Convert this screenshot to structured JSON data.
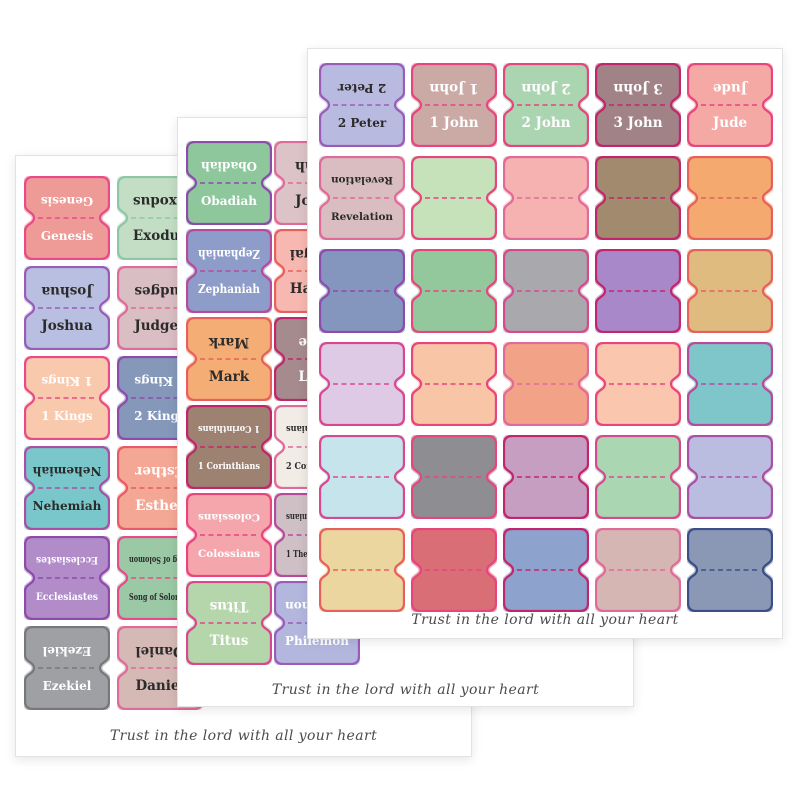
{
  "product": {
    "description": "three overlapping sheets of bible book index tab stickers",
    "quote": "Trust in the lord with all your heart"
  },
  "sheets": [
    {
      "name": "back-sheet-old-testament-1",
      "quote": "Trust in the lord with all your heart",
      "tabs": [
        {
          "row": 0,
          "col": 0,
          "label": "Genesis",
          "fill": "#ee9a96",
          "border": "#e84a8a",
          "ink": "#ffffff"
        },
        {
          "row": 0,
          "col": 1,
          "label": "Exodus",
          "fill": "#c3dec5",
          "border": "#8ec7a8",
          "ink": "#2b2b2b"
        },
        {
          "row": 1,
          "col": 0,
          "label": "Joshua",
          "fill": "#b9bfe0",
          "border": "#9a5cb8",
          "ink": "#2b2b2b"
        },
        {
          "row": 1,
          "col": 1,
          "label": "Judges",
          "fill": "#d9bec4",
          "border": "#e06a9a",
          "ink": "#2b2b2b"
        },
        {
          "row": 2,
          "col": 0,
          "label": "1 Kings",
          "fill": "#f9c9ad",
          "border": "#e84a8a",
          "ink": "#ffffff"
        },
        {
          "row": 2,
          "col": 1,
          "label": "2 Kings",
          "fill": "#8598ba",
          "border": "#8d4bab",
          "ink": "#ffffff"
        },
        {
          "row": 3,
          "col": 0,
          "label": "Nehemiah",
          "fill": "#79c7cb",
          "border": "#a94fa4",
          "ink": "#2b2b2b"
        },
        {
          "row": 3,
          "col": 1,
          "label": "Esther",
          "fill": "#f5a795",
          "border": "#e85a6a",
          "ink": "#ffffff"
        },
        {
          "row": 4,
          "col": 0,
          "label": "Ecclesiastes",
          "fill": "#b28bc9",
          "border": "#8d4bab",
          "ink": "#ffffff"
        },
        {
          "row": 4,
          "col": 1,
          "label": "Song of Solomon",
          "fill": "#9bc9a5",
          "border": "#e84a8a",
          "ink": "#2b2b2b"
        },
        {
          "row": 5,
          "col": 0,
          "label": "Ezekiel",
          "fill": "#9fa0a4",
          "border": "#77787c",
          "ink": "#ffffff"
        },
        {
          "row": 5,
          "col": 1,
          "label": "Daniel",
          "fill": "#d5b9b5",
          "border": "#e06a9a",
          "ink": "#2b2b2b"
        }
      ]
    },
    {
      "name": "middle-sheet-prophets-new-testament",
      "quote": "Trust in the lord with all your heart",
      "tabs": [
        {
          "row": 0,
          "col": 0,
          "label": "Obadiah",
          "fill": "#8dc79b",
          "border": "#8d4bab",
          "ink": "#ffffff"
        },
        {
          "row": 0,
          "col": 1,
          "label": "Jonah",
          "fill": "#dcc3c7",
          "border": "#e06a9a",
          "ink": "#2b2b2b"
        },
        {
          "row": 1,
          "col": 0,
          "label": "Zephaniah",
          "fill": "#8d9cc9",
          "border": "#b84a9e",
          "ink": "#ffffff"
        },
        {
          "row": 1,
          "col": 1,
          "label": "Haggai",
          "fill": "#f6b8b0",
          "border": "#e8605e",
          "ink": "#2b2b2b"
        },
        {
          "row": 2,
          "col": 0,
          "label": "Mark",
          "fill": "#f5ad76",
          "border": "#e8605e",
          "ink": "#2b2b2b"
        },
        {
          "row": 2,
          "col": 1,
          "label": "Luke",
          "fill": "#a58a8e",
          "border": "#c2256b",
          "ink": "#ffffff"
        },
        {
          "row": 3,
          "col": 0,
          "label": "1 Corinthians",
          "fill": "#9d8271",
          "border": "#c2256b",
          "ink": "#ffffff"
        },
        {
          "row": 3,
          "col": 1,
          "label": "2 Corinthians",
          "fill": "#f2ece6",
          "border": "#e06a9a",
          "ink": "#2b2b2b"
        },
        {
          "row": 4,
          "col": 0,
          "label": "Colossians",
          "fill": "#f5a6ad",
          "border": "#e8447e",
          "ink": "#ffffff"
        },
        {
          "row": 4,
          "col": 1,
          "label": "1 Thessalonians",
          "fill": "#cfc0c6",
          "border": "#b84a9e",
          "ink": "#2b2b2b"
        },
        {
          "row": 5,
          "col": 0,
          "label": "Titus",
          "fill": "#b5d6aa",
          "border": "#d84890",
          "ink": "#ffffff"
        },
        {
          "row": 5,
          "col": 1,
          "label": "Philemon",
          "fill": "#b3b7de",
          "border": "#9a5cb8",
          "ink": "#ffffff"
        }
      ]
    },
    {
      "name": "front-sheet-new-testament-end",
      "quote": "Trust in the lord with all your heart",
      "tabs": [
        {
          "row": 0,
          "col": 0,
          "label": "2 Peter",
          "fill": "#b9badf",
          "border": "#9a5cb8",
          "ink": "#2b2b2b"
        },
        {
          "row": 0,
          "col": 1,
          "label": "1 John",
          "fill": "#cba9a5",
          "border": "#e8447e",
          "ink": "#ffffff"
        },
        {
          "row": 0,
          "col": 2,
          "label": "2 John",
          "fill": "#abd5b1",
          "border": "#e8447e",
          "ink": "#ffffff"
        },
        {
          "row": 0,
          "col": 3,
          "label": "3 John",
          "fill": "#a18287",
          "border": "#c2256b",
          "ink": "#ffffff"
        },
        {
          "row": 0,
          "col": 4,
          "label": "Jude",
          "fill": "#f4a9a5",
          "border": "#e8447e",
          "ink": "#ffffff"
        },
        {
          "row": 1,
          "col": 0,
          "label": "Revelation",
          "fill": "#d9bdc1",
          "border": "#e06a9a",
          "ink": "#2b2b2b"
        },
        {
          "row": 1,
          "col": 1,
          "label": "",
          "fill": "#c5e2bb",
          "border": "#e8447e",
          "ink": "#2b2b2b"
        },
        {
          "row": 1,
          "col": 2,
          "label": "",
          "fill": "#f6b1b1",
          "border": "#e06a9a",
          "ink": "#2b2b2b"
        },
        {
          "row": 1,
          "col": 3,
          "label": "",
          "fill": "#a18a6e",
          "border": "#c2256b",
          "ink": "#2b2b2b"
        },
        {
          "row": 1,
          "col": 4,
          "label": "",
          "fill": "#f4a96e",
          "border": "#e8605e",
          "ink": "#2b2b2b"
        },
        {
          "row": 2,
          "col": 0,
          "label": "",
          "fill": "#8496be",
          "border": "#8d4bab",
          "ink": "#2b2b2b"
        },
        {
          "row": 2,
          "col": 1,
          "label": "",
          "fill": "#93c89d",
          "border": "#e8447e",
          "ink": "#2b2b2b"
        },
        {
          "row": 2,
          "col": 2,
          "label": "",
          "fill": "#a9a9ad",
          "border": "#d84890",
          "ink": "#2b2b2b"
        },
        {
          "row": 2,
          "col": 3,
          "label": "",
          "fill": "#a888c8",
          "border": "#c2256b",
          "ink": "#2b2b2b"
        },
        {
          "row": 2,
          "col": 4,
          "label": "",
          "fill": "#dfbb80",
          "border": "#e8605e",
          "ink": "#2b2b2b"
        },
        {
          "row": 3,
          "col": 0,
          "label": "",
          "fill": "#dfcae6",
          "border": "#d84890",
          "ink": "#2b2b2b"
        },
        {
          "row": 3,
          "col": 1,
          "label": "",
          "fill": "#f8c6a6",
          "border": "#e8447e",
          "ink": "#2b2b2b"
        },
        {
          "row": 3,
          "col": 2,
          "label": "",
          "fill": "#f2a286",
          "border": "#e06a9a",
          "ink": "#2b2b2b"
        },
        {
          "row": 3,
          "col": 3,
          "label": "",
          "fill": "#fac6ae",
          "border": "#e8447e",
          "ink": "#2b2b2b"
        },
        {
          "row": 3,
          "col": 4,
          "label": "",
          "fill": "#7ec6c9",
          "border": "#b84a9e",
          "ink": "#2b2b2b"
        },
        {
          "row": 4,
          "col": 0,
          "label": "",
          "fill": "#c6e4ec",
          "border": "#d84890",
          "ink": "#2b2b2b"
        },
        {
          "row": 4,
          "col": 1,
          "label": "",
          "fill": "#8e8e92",
          "border": "#e8447e",
          "ink": "#2b2b2b"
        },
        {
          "row": 4,
          "col": 2,
          "label": "",
          "fill": "#c69ec2",
          "border": "#c2256b",
          "ink": "#2b2b2b"
        },
        {
          "row": 4,
          "col": 3,
          "label": "",
          "fill": "#aad6b2",
          "border": "#d84890",
          "ink": "#2b2b2b"
        },
        {
          "row": 4,
          "col": 4,
          "label": "",
          "fill": "#babce0",
          "border": "#a94fa4",
          "ink": "#2b2b2b"
        },
        {
          "row": 5,
          "col": 0,
          "label": "",
          "fill": "#ead69e",
          "border": "#e8605e",
          "ink": "#2b2b2b"
        },
        {
          "row": 5,
          "col": 1,
          "label": "",
          "fill": "#da6e76",
          "border": "#e8447e",
          "ink": "#2b2b2b"
        },
        {
          "row": 5,
          "col": 2,
          "label": "",
          "fill": "#8ea2ce",
          "border": "#c2256b",
          "ink": "#2b2b2b"
        },
        {
          "row": 5,
          "col": 3,
          "label": "",
          "fill": "#d6b6b2",
          "border": "#e06a9a",
          "ink": "#2b2b2b"
        },
        {
          "row": 5,
          "col": 4,
          "label": "",
          "fill": "#8a98b6",
          "border": "#3c4e86",
          "ink": "#2b2b2b"
        }
      ]
    }
  ]
}
